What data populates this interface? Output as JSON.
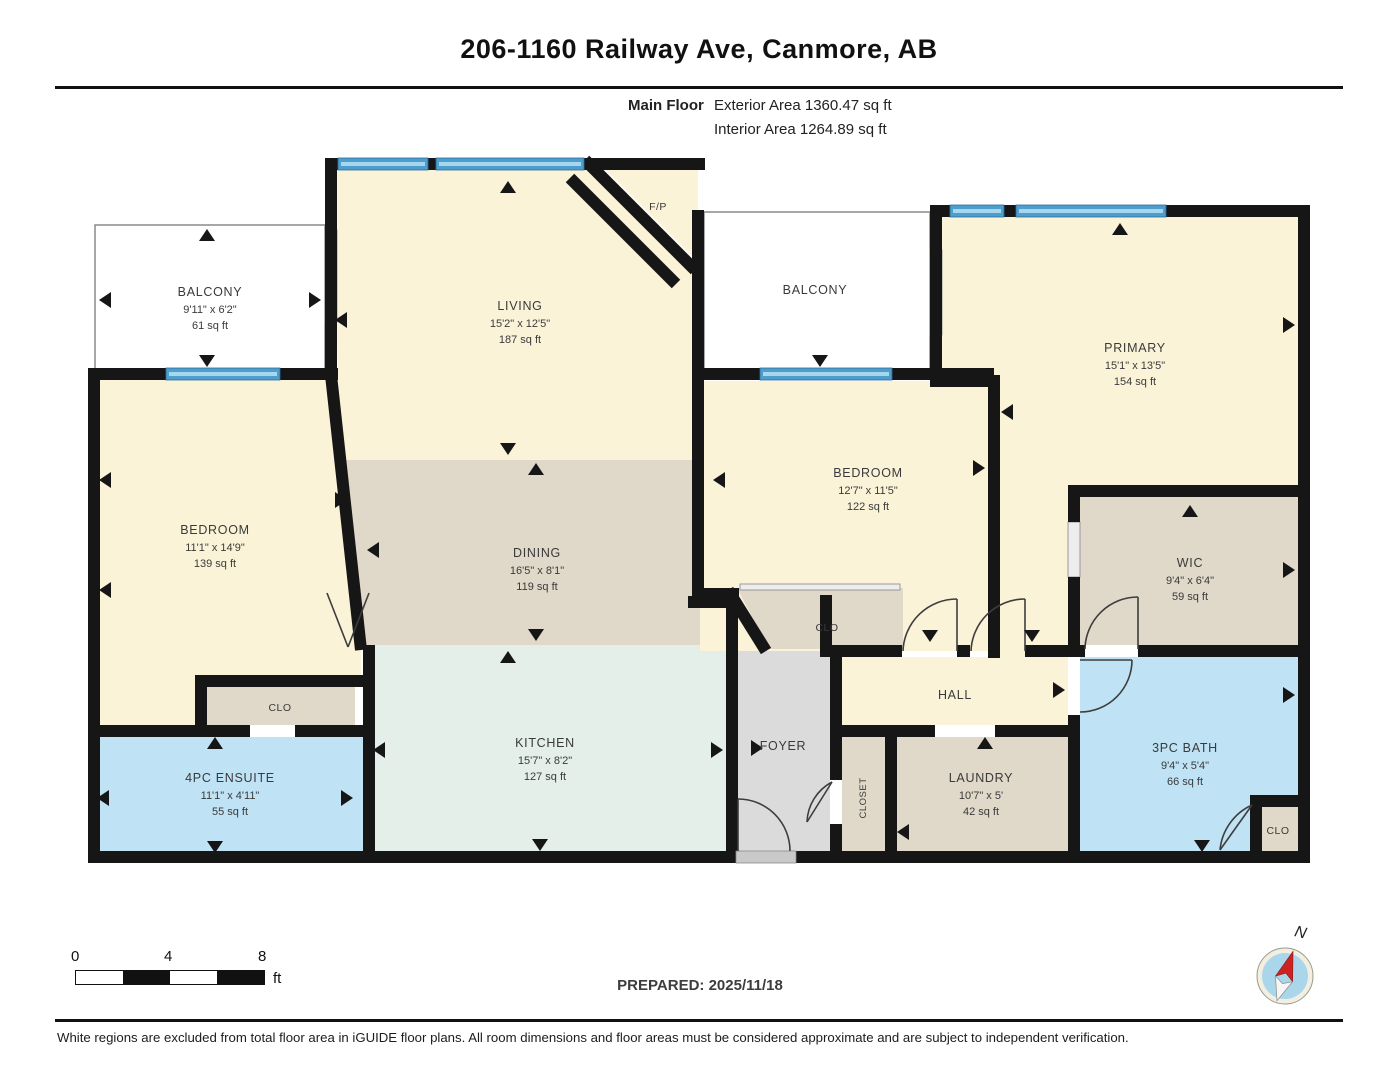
{
  "header": {
    "title": "206-1160 Railway Ave, Canmore, AB",
    "floor_label": "Main Floor",
    "exterior_area": "Exterior Area 1360.47 sq ft",
    "interior_area": "Interior Area 1264.89 sq ft"
  },
  "rooms": [
    {
      "name": "BALCONY",
      "dims": "9'11\" x 6'2\"",
      "area": "61 sq ft"
    },
    {
      "name": "LIVING",
      "dims": "15'2\" x 12'5\"",
      "area": "187 sq ft"
    },
    {
      "name": "F/P"
    },
    {
      "name": "BALCONY"
    },
    {
      "name": "PRIMARY",
      "dims": "15'1\" x 13'5\"",
      "area": "154 sq ft"
    },
    {
      "name": "BEDROOM",
      "dims": "11'1\" x 14'9\"",
      "area": "139 sq ft"
    },
    {
      "name": "DINING",
      "dims": "16'5\" x 8'1\"",
      "area": "119 sq ft"
    },
    {
      "name": "BEDROOM",
      "dims": "12'7\" x 11'5\"",
      "area": "122 sq ft"
    },
    {
      "name": "WIC",
      "dims": "9'4\" x 6'4\"",
      "area": "59 sq ft"
    },
    {
      "name": "CLO"
    },
    {
      "name": "HALL"
    },
    {
      "name": "KITCHEN",
      "dims": "15'7\" x 8'2\"",
      "area": "127 sq ft"
    },
    {
      "name": "FOYER"
    },
    {
      "name": "CLOSET"
    },
    {
      "name": "LAUNDRY",
      "dims": "10'7\" x 5'",
      "area": "42 sq ft"
    },
    {
      "name": "3PC BATH",
      "dims": "9'4\" x 5'4\"",
      "area": "66 sq ft"
    },
    {
      "name": "CLO"
    },
    {
      "name": "CLO"
    },
    {
      "name": "4PC ENSUITE",
      "dims": "11'1\" x 4'11\"",
      "area": "55 sq ft"
    }
  ],
  "scale_bar": {
    "ticks": [
      "0",
      "4",
      "8"
    ],
    "unit": "ft"
  },
  "compass": {
    "label": "N"
  },
  "footer": {
    "prepared": "PREPARED: 2025/11/18",
    "disclaimer": "White regions are excluded from total floor area in iGUIDE floor plans. All room dimensions and floor areas must be considered approximate and are subject to independent verification."
  },
  "colors": {
    "wall": "#161616",
    "room_cream": "#FBF3D8",
    "room_tan": "#E0D8C9",
    "room_mint": "#E3EFE8",
    "room_blue": "#BFE2F4",
    "room_gray": "#DBDBDB",
    "window_blue": "#4D9DCD",
    "compass_blue": "#A9D6EA",
    "compass_red": "#CC2222"
  }
}
